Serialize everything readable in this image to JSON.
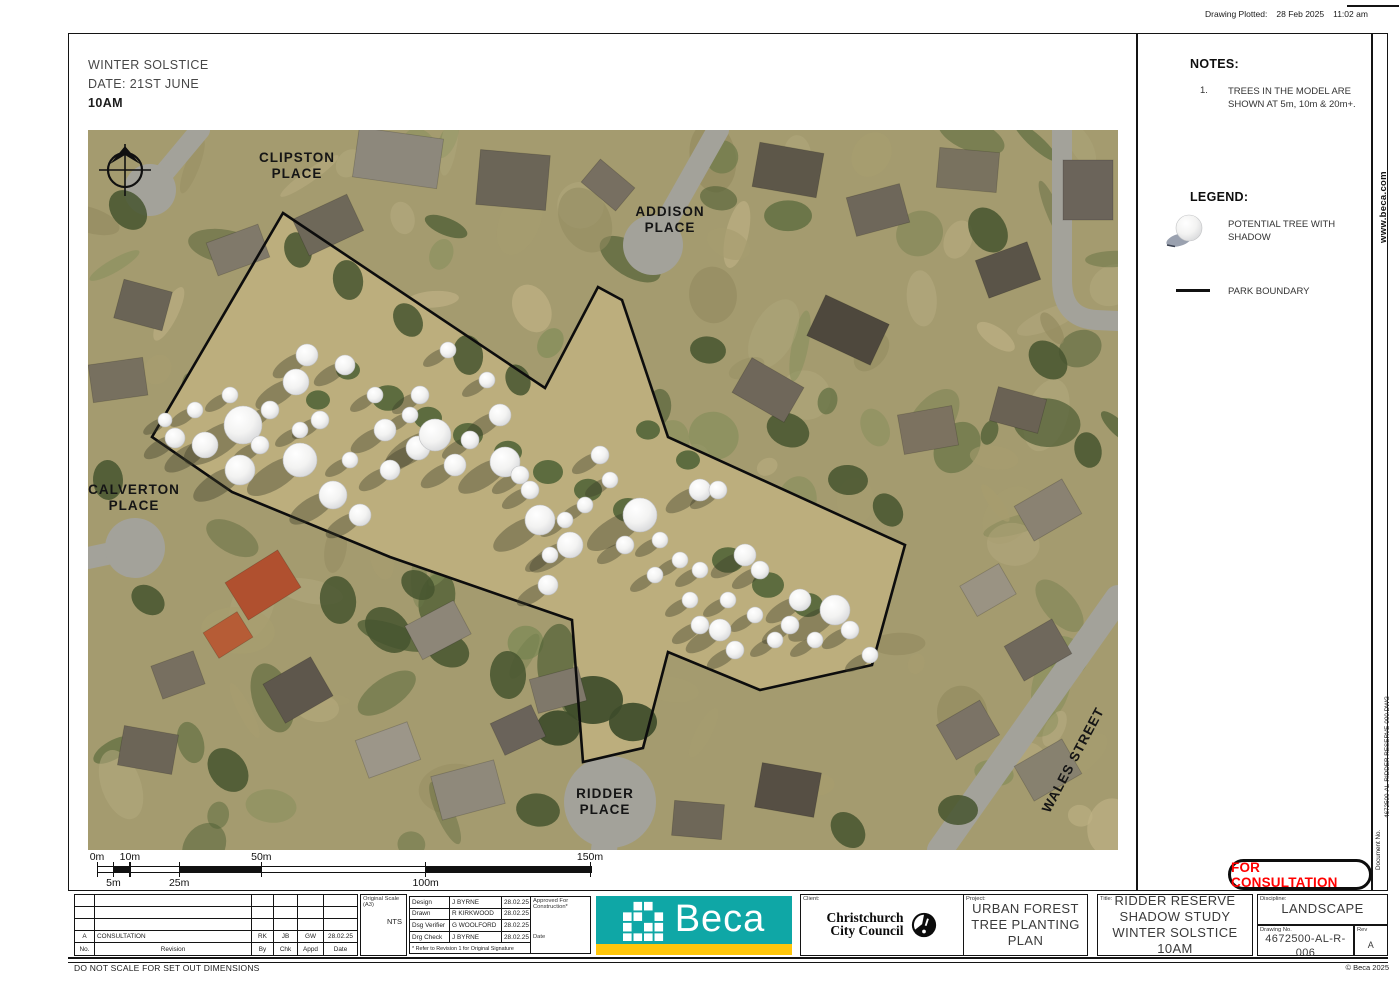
{
  "plot_info": {
    "label": "Drawing Plotted:",
    "date": "28 Feb 2025",
    "time": "11:02 am"
  },
  "scenario": {
    "line1": "WINTER SOLSTICE",
    "line2": "DATE: 21ST JUNE",
    "line3": "10AM"
  },
  "notes": {
    "heading": "NOTES:",
    "items": [
      {
        "num": "1.",
        "text": "TREES IN THE MODEL ARE SHOWN AT 5m, 10m & 20m+."
      }
    ]
  },
  "legend": {
    "heading": "LEGEND:",
    "items": [
      {
        "symbol": "tree-with-shadow-icon",
        "label": "POTENTIAL TREE WITH SHADOW"
      },
      {
        "symbol": "boundary-line-icon",
        "label": "PARK BOUNDARY"
      }
    ]
  },
  "website": "www.beca.com",
  "document_no": {
    "label": "Document No.",
    "value": "4672500-AL-RIDDER RESERVE-000.DWG"
  },
  "map": {
    "streets": [
      {
        "lines": [
          "CLIPSTON",
          "PLACE"
        ],
        "x": 209,
        "y": 32,
        "rot": 0
      },
      {
        "lines": [
          "ADDISON",
          "PLACE"
        ],
        "x": 582,
        "y": 86,
        "rot": 0
      },
      {
        "lines": [
          "CALVERTON",
          "PLACE"
        ],
        "x": 46,
        "y": 364,
        "rot": 0
      },
      {
        "lines": [
          "RIDDER",
          "PLACE"
        ],
        "x": 517,
        "y": 668,
        "rot": 0
      },
      {
        "lines": [
          "WALES STREET"
        ],
        "x": 989,
        "y": 632,
        "rot": -62
      }
    ],
    "boundary": [
      [
        195,
        83
      ],
      [
        457,
        258
      ],
      [
        510,
        157
      ],
      [
        534,
        170
      ],
      [
        580,
        307
      ],
      [
        817,
        415
      ],
      [
        784,
        535
      ],
      [
        672,
        560
      ],
      [
        580,
        522
      ],
      [
        555,
        618
      ],
      [
        495,
        632
      ],
      [
        484,
        490
      ],
      [
        302,
        427
      ],
      [
        144,
        362
      ],
      [
        64,
        307
      ]
    ],
    "trees": [
      [
        87,
        308,
        10
      ],
      [
        117,
        315,
        13
      ],
      [
        155,
        295,
        19
      ],
      [
        152,
        340,
        15
      ],
      [
        212,
        330,
        17
      ],
      [
        208,
        252,
        13
      ],
      [
        219,
        225,
        11
      ],
      [
        257,
        235,
        10
      ],
      [
        297,
        300,
        11
      ],
      [
        245,
        365,
        14
      ],
      [
        272,
        385,
        11
      ],
      [
        302,
        340,
        10
      ],
      [
        330,
        318,
        12
      ],
      [
        347,
        305,
        16
      ],
      [
        367,
        335,
        11
      ],
      [
        412,
        285,
        11
      ],
      [
        417,
        332,
        15
      ],
      [
        452,
        390,
        15
      ],
      [
        482,
        415,
        13
      ],
      [
        460,
        455,
        10
      ],
      [
        432,
        345,
        9
      ],
      [
        512,
        325,
        9
      ],
      [
        552,
        385,
        17
      ],
      [
        612,
        360,
        11
      ],
      [
        630,
        360,
        9
      ],
      [
        657,
        425,
        11
      ],
      [
        672,
        440,
        9
      ],
      [
        712,
        470,
        11
      ],
      [
        747,
        480,
        15
      ],
      [
        632,
        500,
        11
      ],
      [
        647,
        520,
        9
      ],
      [
        612,
        495,
        9
      ],
      [
        687,
        510,
        8
      ],
      [
        782,
        525,
        8
      ],
      [
        360,
        220,
        8
      ],
      [
        399,
        250,
        8
      ],
      [
        332,
        265,
        9
      ],
      [
        182,
        280,
        9
      ],
      [
        142,
        265,
        8
      ],
      [
        262,
        330,
        8
      ],
      [
        287,
        265,
        8
      ],
      [
        212,
        300,
        8
      ],
      [
        462,
        425,
        8
      ],
      [
        477,
        390,
        8
      ],
      [
        522,
        350,
        8
      ],
      [
        572,
        410,
        8
      ],
      [
        592,
        430,
        8
      ],
      [
        612,
        440,
        8
      ],
      [
        640,
        470,
        8
      ],
      [
        667,
        485,
        8
      ],
      [
        702,
        495,
        9
      ],
      [
        727,
        510,
        8
      ],
      [
        762,
        500,
        9
      ],
      [
        77,
        290,
        7
      ],
      [
        107,
        280,
        8
      ],
      [
        172,
        315,
        9
      ],
      [
        232,
        290,
        9
      ],
      [
        322,
        285,
        8
      ],
      [
        382,
        310,
        9
      ],
      [
        442,
        360,
        9
      ],
      [
        497,
        375,
        8
      ],
      [
        537,
        415,
        9
      ],
      [
        567,
        445,
        8
      ],
      [
        602,
        470,
        8
      ]
    ]
  },
  "scalebar": {
    "stops": [
      0,
      5,
      10,
      25,
      50,
      100,
      150
    ],
    "top_labels": [
      {
        "text": "0m",
        "value": 0
      },
      {
        "text": "10m",
        "value": 10
      },
      {
        "text": "50m",
        "value": 50
      },
      {
        "text": "150m",
        "value": 150
      }
    ],
    "bottom_labels": [
      {
        "text": "5m",
        "value": 5
      },
      {
        "text": "25m",
        "value": 25
      },
      {
        "text": "100m",
        "value": 100
      }
    ]
  },
  "title_block": {
    "revision_table": {
      "headers": {
        "no": "No.",
        "revision": "Revision",
        "by": "By",
        "chk": "Chk",
        "appd": "Appd",
        "date": "Date"
      },
      "rows": [
        {
          "no": "A",
          "revision": "CONSULTATION",
          "by": "RK",
          "chk": "JB",
          "appd": "GW",
          "date": "28.02.25"
        }
      ]
    },
    "scale": {
      "label": "Original Scale (A3)",
      "value": "NTS"
    },
    "personnel": [
      {
        "role": "Design",
        "name": "J BYRNE",
        "date": "28.02.25"
      },
      {
        "role": "Drawn",
        "name": "R KIRKWOOD",
        "date": "28.02.25"
      },
      {
        "role": "Dsg Verifier",
        "name": "G WOOLFORD",
        "date": "28.02.25"
      },
      {
        "role": "Drg Check",
        "name": "J BYRNE",
        "date": "28.02.25"
      }
    ],
    "approved": {
      "label": "Approved For Construction*",
      "date_label": "Date"
    },
    "footnote": "* Refer to Revision 1 for Original Signature",
    "beca": {
      "wordmark": "Beca",
      "teal": "#0FA7A6",
      "yellow": "#FFC60B"
    },
    "client": {
      "label": "Client:",
      "name_lines": [
        "Christchurch",
        "City Council"
      ]
    },
    "project": {
      "label": "Project:",
      "lines": [
        "URBAN FOREST",
        "TREE PLANTING",
        "PLAN"
      ]
    },
    "sheet_title": {
      "label": "Title:",
      "lines": [
        "RIDDER RESERVE",
        "SHADOW STUDY",
        "WINTER SOLSTICE 10AM"
      ]
    },
    "discipline": {
      "label": "Discipline:",
      "value": "LANDSCAPE"
    },
    "drawing_no": {
      "label": "Drawing No.",
      "value": "4672500-AL-R-006"
    },
    "rev": {
      "label": "Rev",
      "value": "A"
    },
    "stamp": "FOR CONSULTATION",
    "copyright": "© Beca 2025",
    "do_not_scale": "DO NOT SCALE FOR SET OUT DIMENSIONS"
  }
}
